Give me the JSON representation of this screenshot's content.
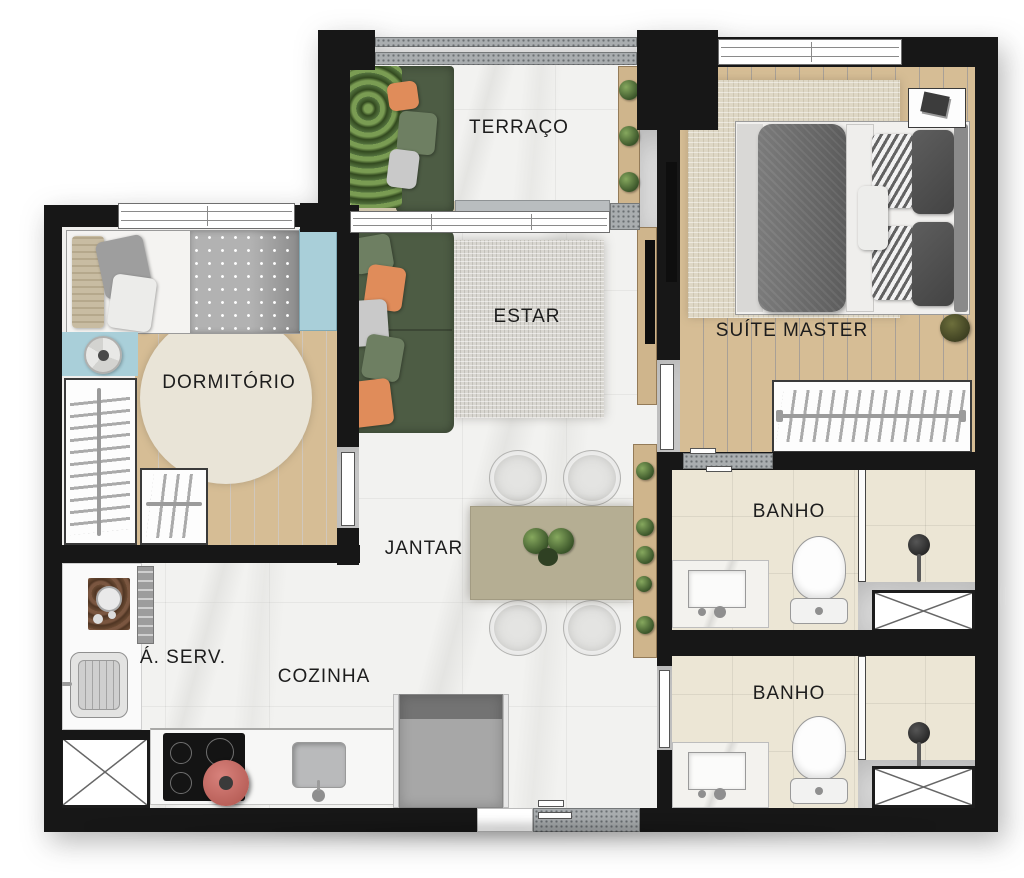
{
  "plan": {
    "type": "apartment-floor-plan",
    "rooms": [
      {
        "id": "terraco",
        "label": "TERRAÇO"
      },
      {
        "id": "suite-master",
        "label": "SUÍTE MASTER"
      },
      {
        "id": "estar",
        "label": "ESTAR"
      },
      {
        "id": "dormitorio",
        "label": "DORMITÓRIO"
      },
      {
        "id": "jantar",
        "label": "JANTAR"
      },
      {
        "id": "banho-1",
        "label": "BANHO"
      },
      {
        "id": "banho-2",
        "label": "BANHO"
      },
      {
        "id": "area-servico",
        "label": "Á. SERV."
      },
      {
        "id": "cozinha",
        "label": "COZINHA"
      }
    ],
    "colors": {
      "wall": "#171717",
      "wood_floor": "#d6bd95",
      "wood_light": "#cfb58c",
      "marble_floor": "#f2f2f0",
      "bath_tile": "#ece6d5",
      "rug_beige": "#ded7c5",
      "rug_gray": "#d8d6d0",
      "rug_round": "#e9e4d7",
      "sofa_green": "#4d5c44",
      "pillow_green": "#6e7f62",
      "pillow_orange": "#e08c5a",
      "pillow_gray": "#c9c9c9",
      "table_khaki": "#b5ae93",
      "accent_blue": "#a9cfd9",
      "concrete_gray": "#a9adaf",
      "plant_green": "#4e6b38"
    }
  }
}
